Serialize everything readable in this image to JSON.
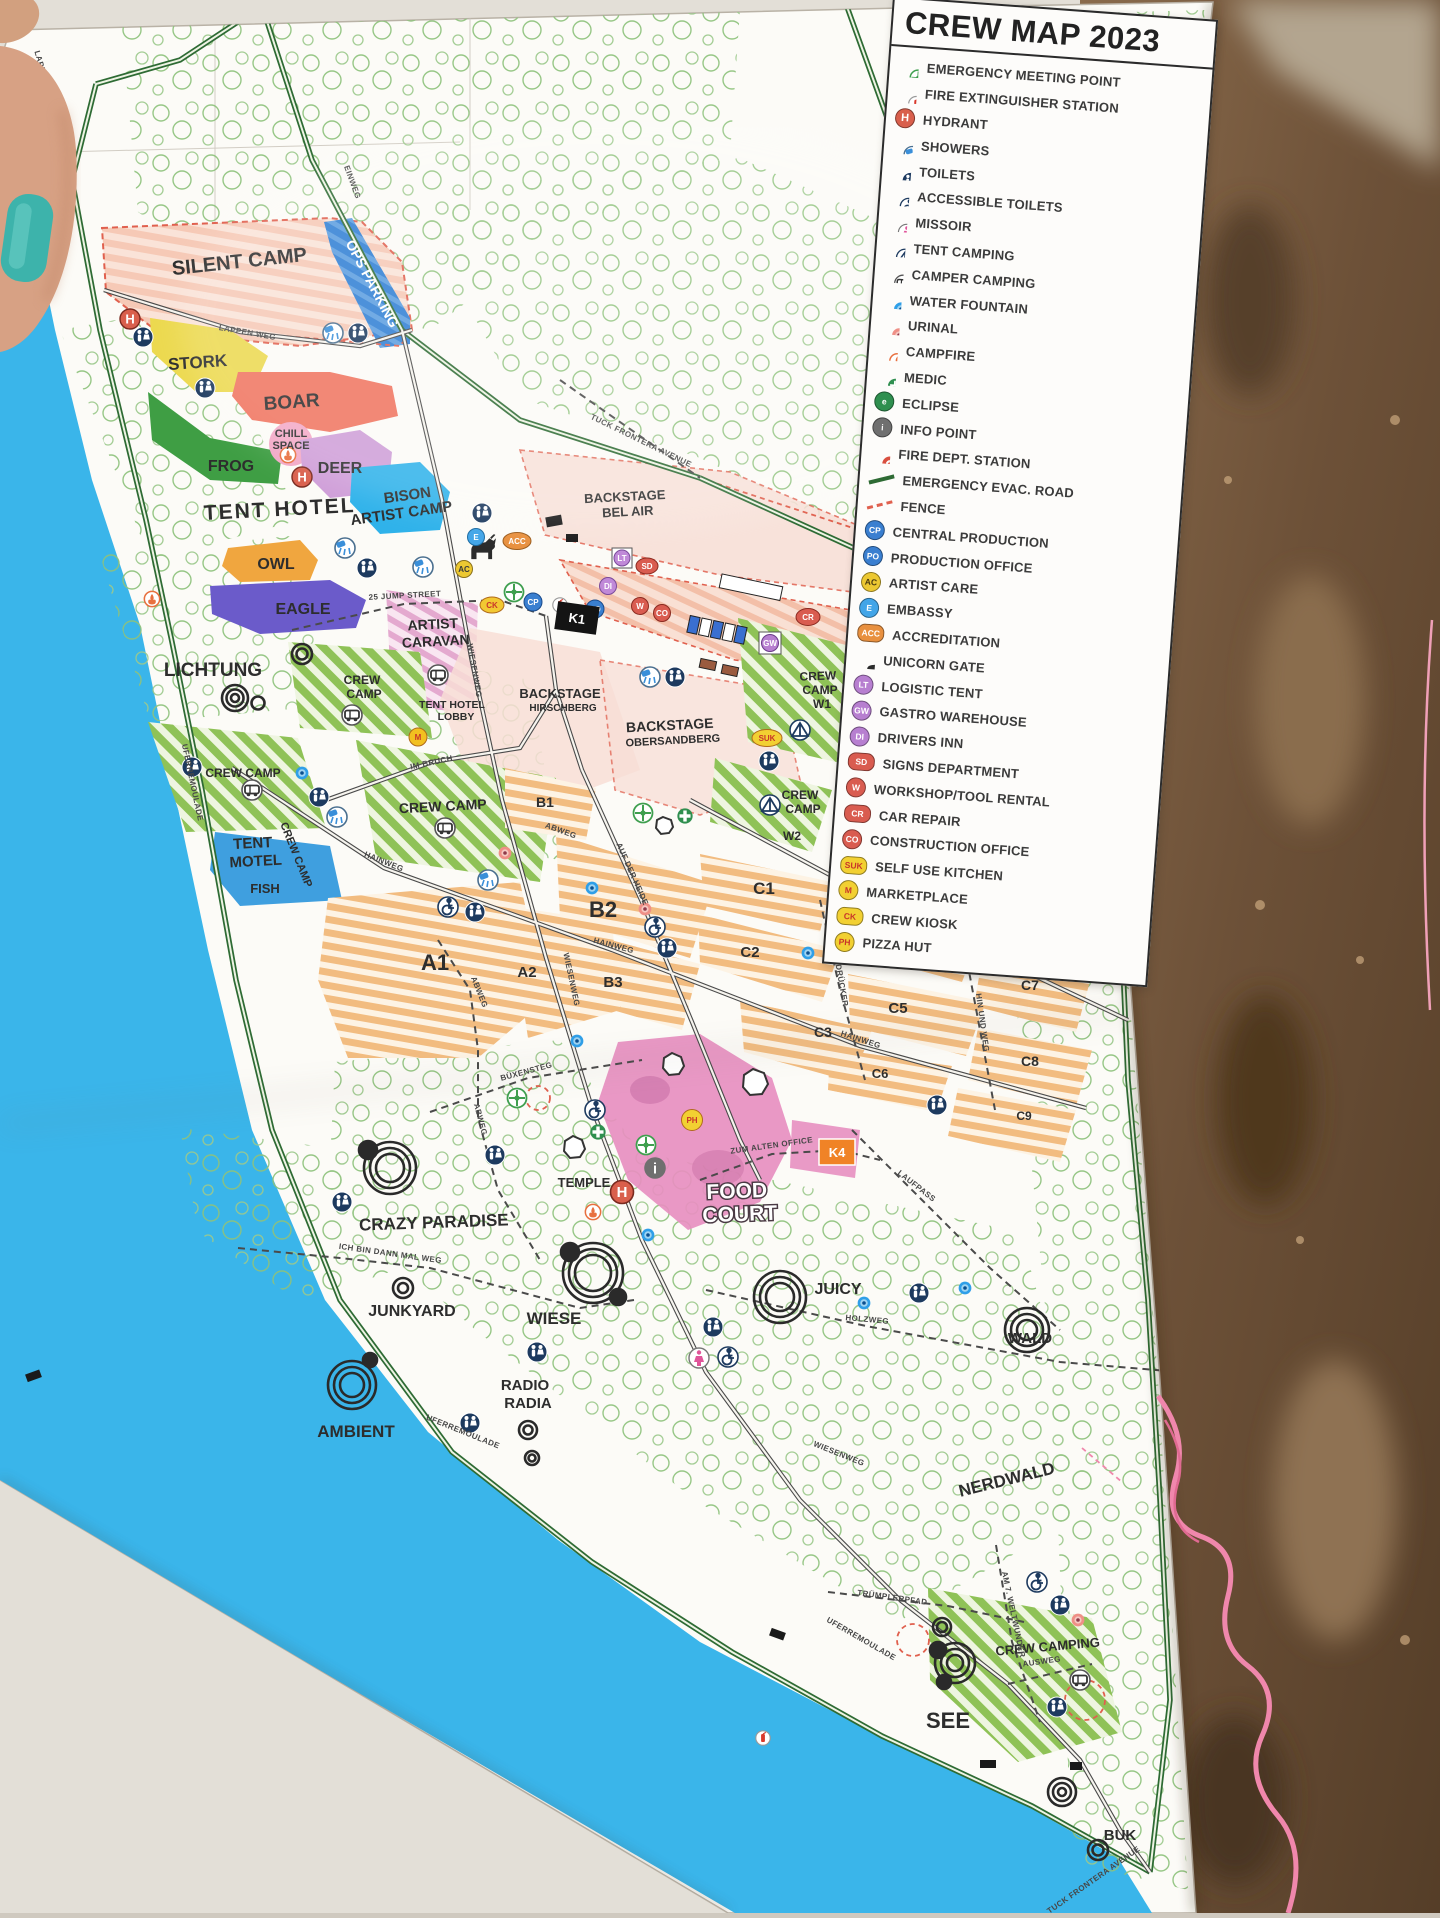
{
  "title": "CREW MAP 2023",
  "legend": {
    "items": [
      {
        "label": "EMERGENCY MEETING POINT",
        "badge": ""
      },
      {
        "label": "FIRE EXTINGUISHER STATION",
        "badge": ""
      },
      {
        "label": "HYDRANT",
        "badge": "H"
      },
      {
        "label": "SHOWERS",
        "badge": ""
      },
      {
        "label": "TOILETS",
        "badge": ""
      },
      {
        "label": "ACCESSIBLE TOILETS",
        "badge": ""
      },
      {
        "label": "MISSOIR",
        "badge": ""
      },
      {
        "label": "TENT CAMPING",
        "badge": ""
      },
      {
        "label": "CAMPER CAMPING",
        "badge": ""
      },
      {
        "label": "WATER FOUNTAIN",
        "badge": ""
      },
      {
        "label": "URINAL",
        "badge": ""
      },
      {
        "label": "CAMPFIRE",
        "badge": ""
      },
      {
        "label": "MEDIC",
        "badge": ""
      },
      {
        "label": "ECLIPSE",
        "badge": "e"
      },
      {
        "label": "INFO POINT",
        "badge": "i"
      },
      {
        "label": "FIRE DEPT. STATION",
        "badge": ""
      },
      {
        "label": "EMERGENCY EVAC. ROAD",
        "badge": ""
      },
      {
        "label": "FENCE",
        "badge": ""
      },
      {
        "label": "CENTRAL PRODUCTION",
        "badge": "CP"
      },
      {
        "label": "PRODUCTION OFFICE",
        "badge": "PO"
      },
      {
        "label": "ARTIST CARE",
        "badge": "AC"
      },
      {
        "label": "EMBASSY",
        "badge": "E"
      },
      {
        "label": "ACCREDITATION",
        "badge": "ACC"
      },
      {
        "label": "UNICORN GATE",
        "badge": ""
      },
      {
        "label": "LOGISTIC TENT",
        "badge": "LT"
      },
      {
        "label": "GASTRO WAREHOUSE",
        "badge": "GW"
      },
      {
        "label": "DRIVERS INN",
        "badge": "DI"
      },
      {
        "label": "SIGNS DEPARTMENT",
        "badge": "SD"
      },
      {
        "label": "WORKSHOP/TOOL RENTAL",
        "badge": "W"
      },
      {
        "label": "CAR REPAIR",
        "badge": "CR"
      },
      {
        "label": "CONSTRUCTION OFFICE",
        "badge": "CO"
      },
      {
        "label": "SELF USE KITCHEN",
        "badge": "SUK"
      },
      {
        "label": "MARKETPLACE",
        "badge": "M"
      },
      {
        "label": "CREW KIOSK",
        "badge": "CK"
      },
      {
        "label": "PIZZA HUT",
        "badge": "PH"
      }
    ]
  },
  "map": {
    "place_labels": [
      "SILENT CAMP",
      "OPS PARKING",
      "STORK",
      "BOAR",
      "CHILL",
      "SPACE",
      "FROG",
      "DEER",
      "TENT HOTEL",
      "BISON",
      "ARTIST CAMP",
      "OWL",
      "EAGLE",
      "LICHTUNG",
      "ARTIST",
      "CARAVAN",
      "TENT HOTEL",
      "LOBBY",
      "CREW",
      "CAMP",
      "CREW CAMP",
      "CREW CAMP",
      "CREW CAMP",
      "TENT",
      "MOTEL",
      "FISH",
      "BACKSTAGE",
      "BEL AIR",
      "BACKSTAGE",
      "HIRSCHBERG",
      "BACKSTAGE",
      "OBERSANDBERG",
      "CREW",
      "CAMP",
      "W1",
      "CREW",
      "CAMP",
      "W2",
      "TEMPLE",
      "FOOD",
      "COURT",
      "CRAZY PARADISE",
      "JUNKYARD",
      "WIESE",
      "RADIO",
      "RADIA",
      "AMBIENT",
      "JUICY",
      "WALD",
      "NERDWALD",
      "SEE",
      "CREW CAMPING",
      "BUK"
    ],
    "zone_labels": [
      "A1",
      "A2",
      "B1",
      "B2",
      "B3",
      "C1",
      "C2",
      "C3",
      "C4",
      "C5",
      "C6",
      "C7",
      "C8",
      "C9",
      "W3",
      "W4",
      "W5",
      "K1",
      "K4"
    ],
    "road_labels": [
      "LAPPENWEG",
      "LAPPEN WEG",
      "EINWEG",
      "TUCK FRONTERA AVENUE",
      "25 JUMP STREET",
      "WIESENWEG",
      "IM BRUCH",
      "HAINWEG",
      "HAINWEG",
      "HAINWEG",
      "ABWEG",
      "ABWEG",
      "ABWEG",
      "AUF DER HEIDE",
      "WIESENWEG",
      "UMWEG",
      "AM DRÜCKER",
      "HIN UND WEG",
      "BÜXENSTEG",
      "ZUM ALTEN OFFICE",
      "LAUFPASS",
      "HOLZWEG",
      "ICH BIN DANN MAL WEG",
      "WIESENWEG",
      "UFERREMOULADE",
      "UFERREMOULADE",
      "UFERREMOULADE",
      "TRÜMPLERPFAD",
      "AM 7. WELTWUNDER",
      "AUSWEG",
      "TUCK FRONTERA AVENUE"
    ],
    "badges": [
      "E",
      "ACC",
      "AC",
      "CK",
      "CP",
      "PO",
      "LT",
      "SD",
      "DI",
      "W",
      "CO",
      "CR",
      "GW",
      "SUK",
      "M",
      "PH"
    ]
  },
  "colors": {
    "evac_road": "#2e6b34",
    "fence": "#e0604e",
    "lake": "#3ab5ea",
    "accent_pink": "#e78fc0"
  }
}
